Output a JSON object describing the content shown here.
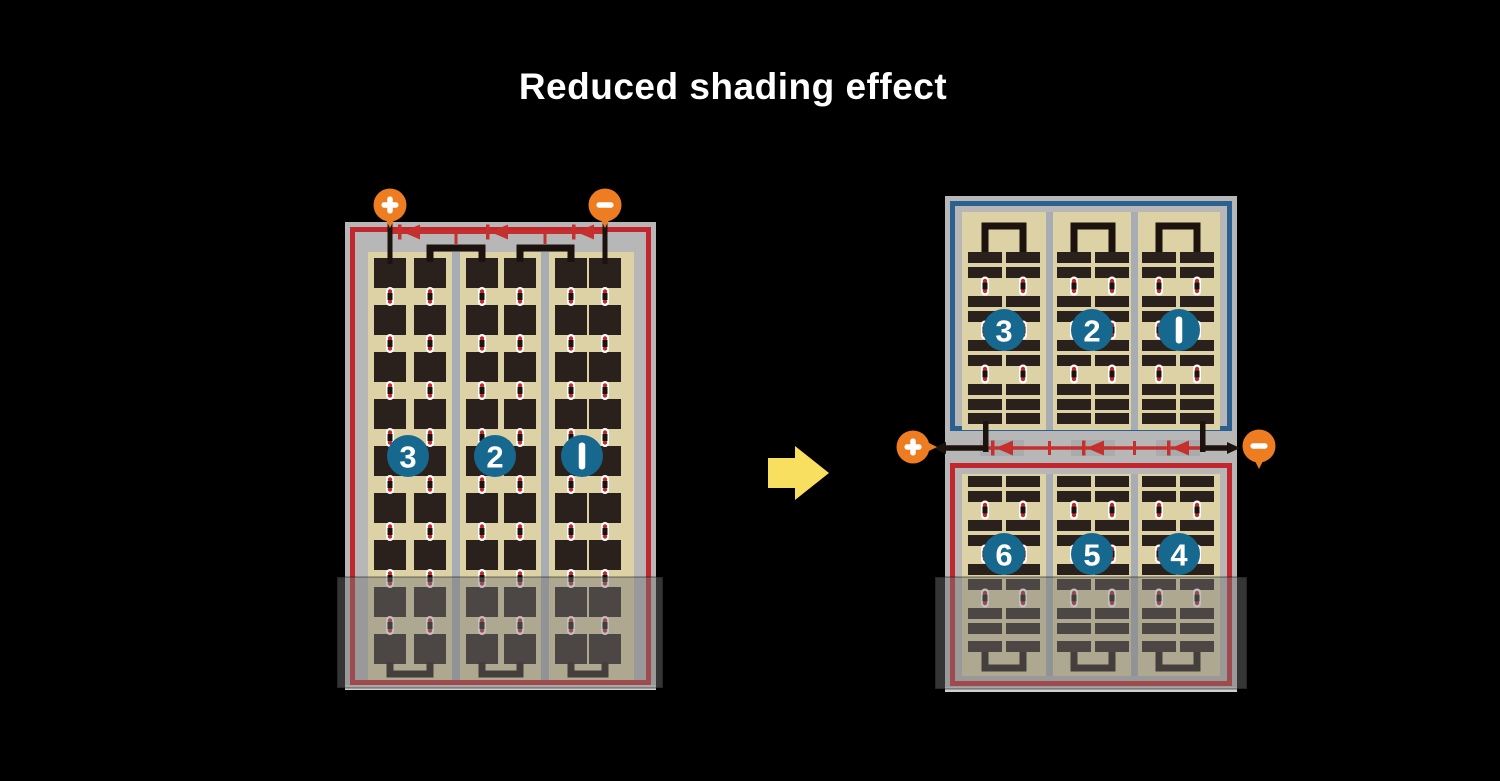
{
  "title": "Reduced shading effect",
  "palette": {
    "background": "#000000",
    "title_text": "#ffffff",
    "frame_gray": "#b7b7b7",
    "frame_edge_light": "#cfcfcf",
    "panel_tan": "#ddd1a6",
    "cell_dark": "#2a211d",
    "divider_gray": "#a8adb3",
    "border_red": "#c1272d",
    "border_blue": "#2a6191",
    "wire_black": "#1c130f",
    "diode_red": "#c5302e",
    "diode_housing_gray": "#a9abad",
    "terminal_orange": "#ee7d22",
    "terminal_glyph_white": "#ffffff",
    "badge_blue": "#16688f",
    "badge_text_white": "#ffffff",
    "connector_white": "#ffffff",
    "connector_dot_red": "#c1272d",
    "arrow_yellow": "#f8df5f",
    "shade_overlay": "rgba(118,118,118,0.45)"
  },
  "left_module": {
    "positive_terminal": "+",
    "negative_terminal": "−",
    "string_numbers": [
      "3",
      "2",
      "1"
    ],
    "bypass_diode_count": 3
  },
  "right_assembly": {
    "positive_terminal": "+",
    "negative_terminal": "−",
    "top_module_string_numbers": [
      "3",
      "2",
      "1"
    ],
    "bottom_module_string_numbers": [
      "6",
      "5",
      "4"
    ],
    "bypass_diode_count": 3
  }
}
